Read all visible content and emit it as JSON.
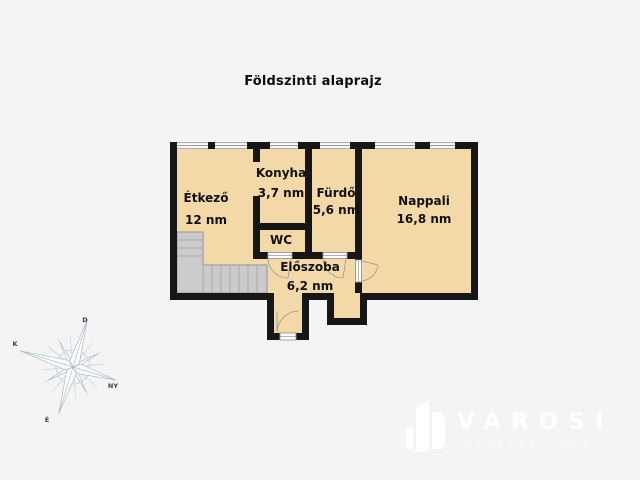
{
  "title": "Földszinti alaprajz",
  "rooms": {
    "etkezo": {
      "name": "Étkező",
      "area": "12 nm"
    },
    "konyha": {
      "name": "Konyha",
      "area": "3,7 nm"
    },
    "furdo": {
      "name": "Fürdő",
      "area": "5,6 nm"
    },
    "nappali": {
      "name": "Nappali",
      "area": "16,8 nm"
    },
    "wc": {
      "name": "WC"
    },
    "eloszoba": {
      "name": "Előszoba",
      "area": "6,2 nm"
    }
  },
  "compass": {
    "north_label": "É",
    "south_label": "D",
    "east_label": "K",
    "west_label": "NY"
  },
  "logo": {
    "name": "VÁROSI",
    "subtitle": "INGATLANIRODA"
  },
  "colors": {
    "background": "#f4f4f5",
    "floor": "#f3d9a7",
    "wall": "#161616",
    "stairs": "#cbcbcb",
    "window_line": "#999999",
    "compass": "#a9bcc7",
    "logo": "#ffffff"
  }
}
